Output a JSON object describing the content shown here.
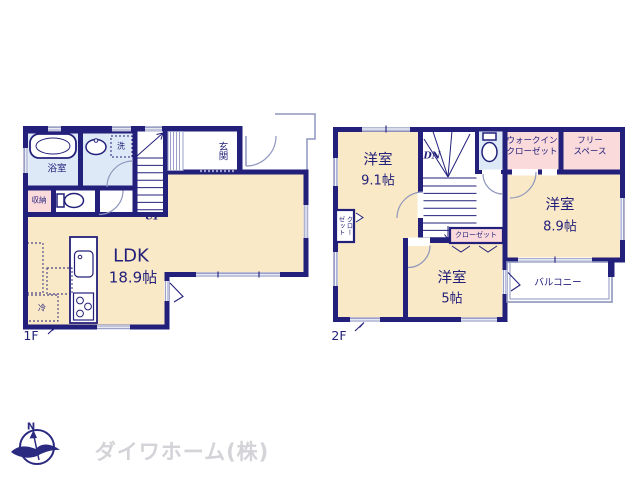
{
  "floor1": {
    "floor_label": "1F",
    "rooms": {
      "bathroom": "浴室",
      "wash": "洗",
      "storage": "収納",
      "entrance": "玄関",
      "stairs_up": "UP",
      "ldk_name": "LDK",
      "ldk_size": "18.9帖",
      "fridge": "冷"
    }
  },
  "floor2": {
    "floor_label": "2F",
    "rooms": {
      "bedroom1_name": "洋室",
      "bedroom1_size": "9.1帖",
      "stairs_down": "DN",
      "wic_line1": "ウォークイン",
      "wic_line2": "クローゼット",
      "free_line1": "フリー",
      "free_line2": "スペース",
      "bedroom2_name": "洋室",
      "bedroom2_size": "8.9帖",
      "closet_box": "クローゼット",
      "closet_side": "クローゼット",
      "bedroom3_name": "洋室",
      "bedroom3_size": "5帖",
      "balcony": "バルコニー"
    }
  },
  "logo": {
    "compass_n": "N",
    "company": "ダイワホーム(株)"
  },
  "colors": {
    "wall_navy": "#23207b",
    "room_cream": "#f9e9c6",
    "accent_pink": "#fadadb",
    "accent_blue": "#dde9f6",
    "thin_line": "#9aa0c8",
    "logo_text_gray": "#d3d3d8"
  }
}
